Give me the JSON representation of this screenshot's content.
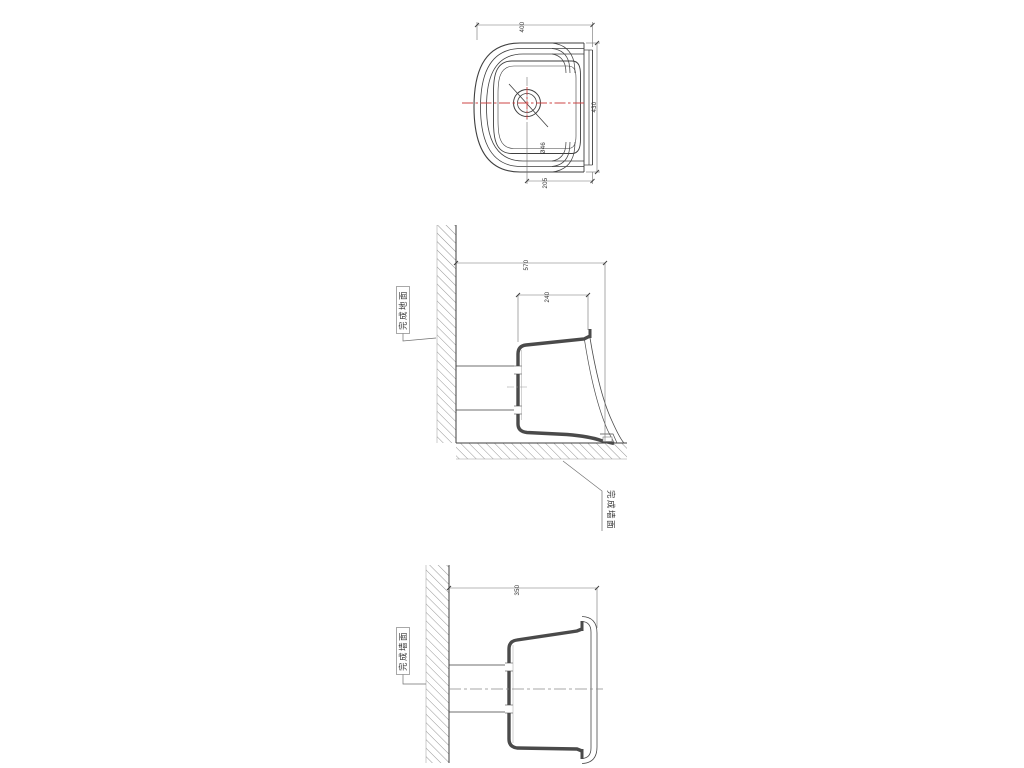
{
  "page": {
    "background": "#ffffff"
  },
  "colors": {
    "line_main": "#3f3f3f",
    "line_hair": "#707070",
    "hatch": "#8a8a8a",
    "centerline_red": "#cc4444",
    "section_fill": "#4a4a4a"
  },
  "views": {
    "plan": {
      "dim_top": "400",
      "dim_right": "430",
      "dim_bottom": "205",
      "drain_label": "Ø46"
    },
    "front_section": {
      "dim_overall": "570",
      "dim_inner": "240",
      "floor_label": "完成地面",
      "wall_label": "完成墙面"
    },
    "side_section": {
      "dim_depth": "350",
      "wall_label": "完成墙面"
    }
  }
}
